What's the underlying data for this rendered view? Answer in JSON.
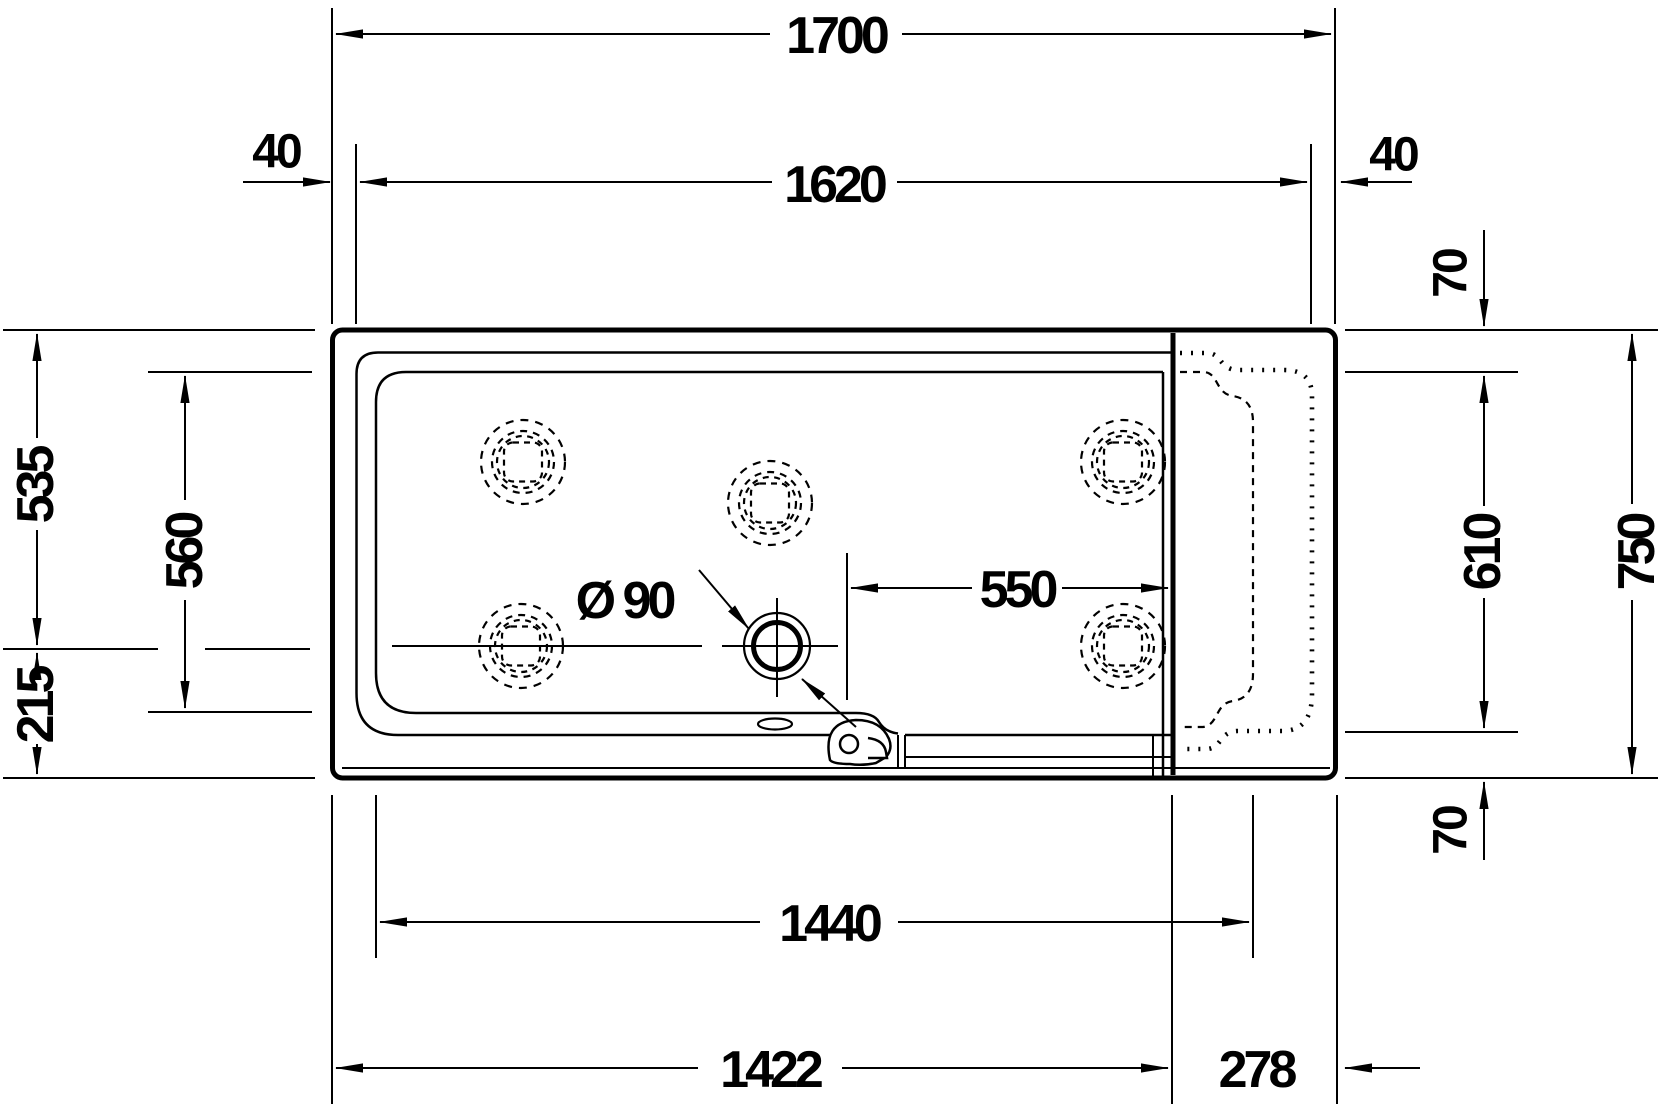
{
  "drawing": {
    "type": "technical-dimension-plan",
    "subject": "bathtub plan view with seat section, whirl jets, drain and door handle",
    "units": "mm",
    "line_color": "#000000",
    "background_color": "#ffffff",
    "labels": {
      "overall_length": "1700",
      "inner_length": "1620",
      "rim_offset_left": "40",
      "rim_offset_right": "40",
      "rim_offset_top": "70",
      "rim_offset_bottom": "70",
      "overall_width": "750",
      "seat_inner_width": "610",
      "top_to_drain_axis": "535",
      "basin_inner_width": "560",
      "drain_axis_to_bottom": "215",
      "drain_diameter": "Ø 90",
      "drain_to_seat": "550",
      "basin_to_seat_recess": "1440",
      "edge_to_seat_panel": "1422",
      "seat_section_length": "278"
    }
  }
}
